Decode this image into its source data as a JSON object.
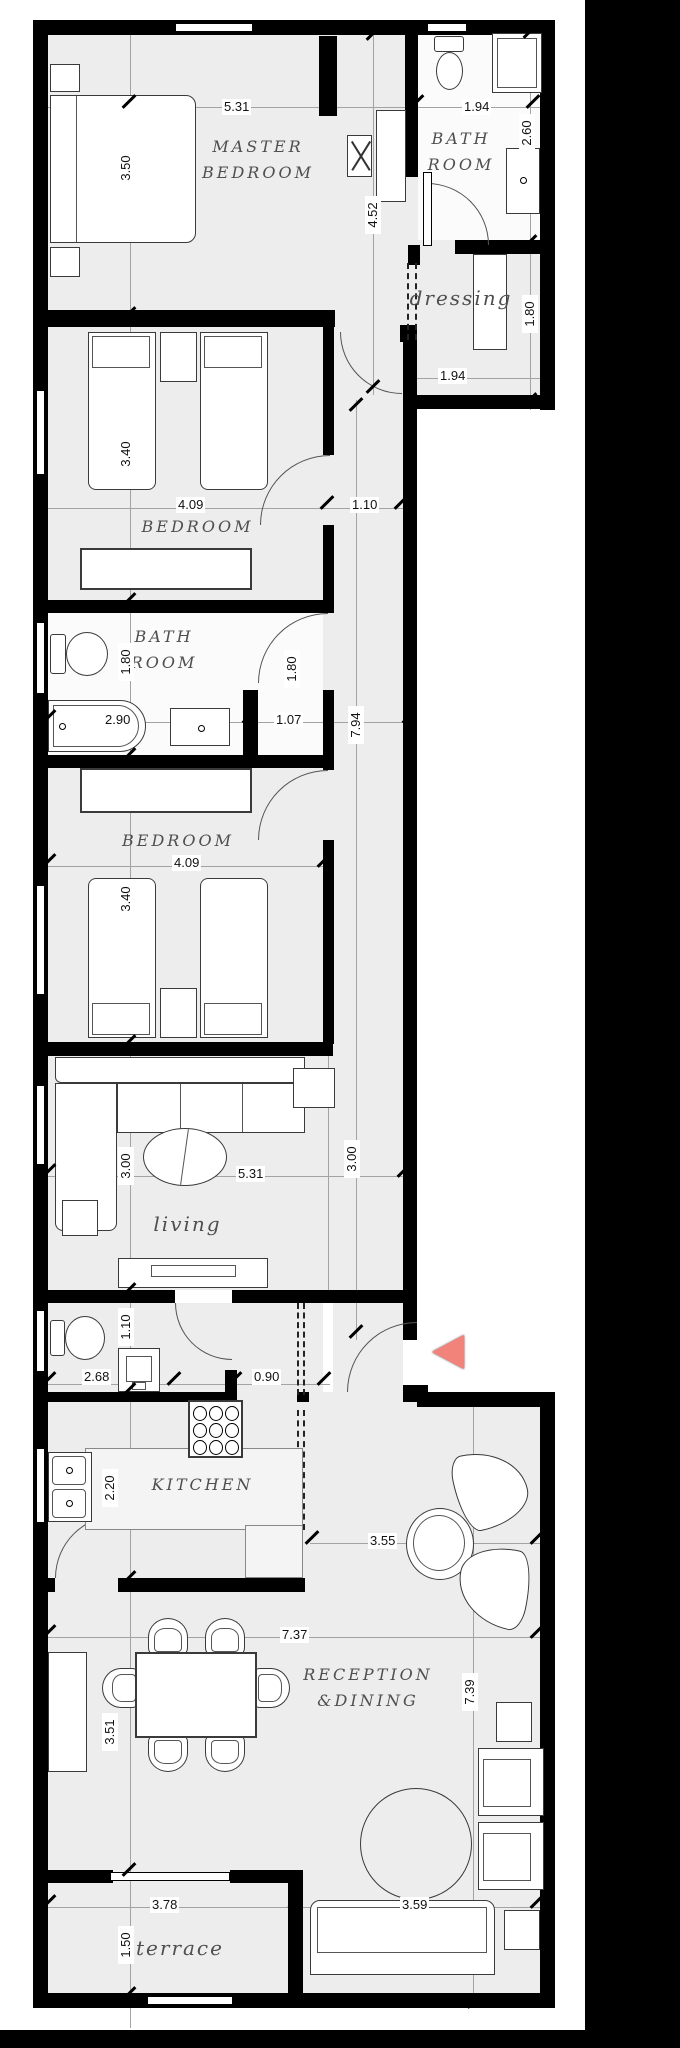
{
  "meta": {
    "type": "floor-plan",
    "orientation": "vertical-strip-apartment"
  },
  "colors": {
    "wall": "#000000",
    "floor": "#ededed",
    "room_light": "#fbfbfb",
    "dim_line": "#a3a3a3",
    "label_text": "#4f4f4f",
    "dim_text": "#111111",
    "entry_arrow": "#f2837b",
    "border_band": "#000000",
    "furniture_border": "#3a3a3a"
  },
  "rooms": {
    "master_bedroom": {
      "line1": "MASTER",
      "line2": "BEDROOM"
    },
    "bath_top": {
      "line1": "BATH",
      "line2": "ROOM"
    },
    "dressing": {
      "label": "dressing"
    },
    "bedroom1": {
      "label": "BEDROOM"
    },
    "bath_mid": {
      "line1": "BATH",
      "line2": "ROOM"
    },
    "bedroom2": {
      "label": "BEDROOM"
    },
    "living": {
      "label": "living"
    },
    "kitchen": {
      "label": "KITCHEN"
    },
    "reception": {
      "line1": "RECEPTION",
      "line2": "&DINING"
    },
    "terrace": {
      "label": "terrace"
    }
  },
  "dims": {
    "master_width": "5.31",
    "bath_top_width": "1.94",
    "bath_top_depth": "2.60",
    "master_depth": "3.50",
    "hall_depth": "4.52",
    "dressing_depth": "1.80",
    "dressing_width": "1.94",
    "bedroom1_depth": "3.40",
    "bedroom1_width": "4.09",
    "corridor_width": "1.10",
    "bath_mid_left_depth": "1.80",
    "bath_mid_right_depth": "1.80",
    "bathtub_width": "2.90",
    "bath_vanity_width": "1.07",
    "corridor_length": "7.94",
    "bedroom2_width": "4.09",
    "bedroom2_depth": "3.40",
    "living_depth_left": "3.00",
    "living_width": "5.31",
    "living_depth_right": "3.00",
    "wc_depth": "1.10",
    "wc_width": "2.68",
    "kitchen_entry_width": "0.90",
    "kitchen_depth": "2.20",
    "sitting_width": "3.55",
    "reception_width": "7.37",
    "dining_depth": "3.51",
    "reception_depth": "7.39",
    "terrace_width": "3.78",
    "terrace_depth": "1.50",
    "sofa_width": "3.59"
  }
}
